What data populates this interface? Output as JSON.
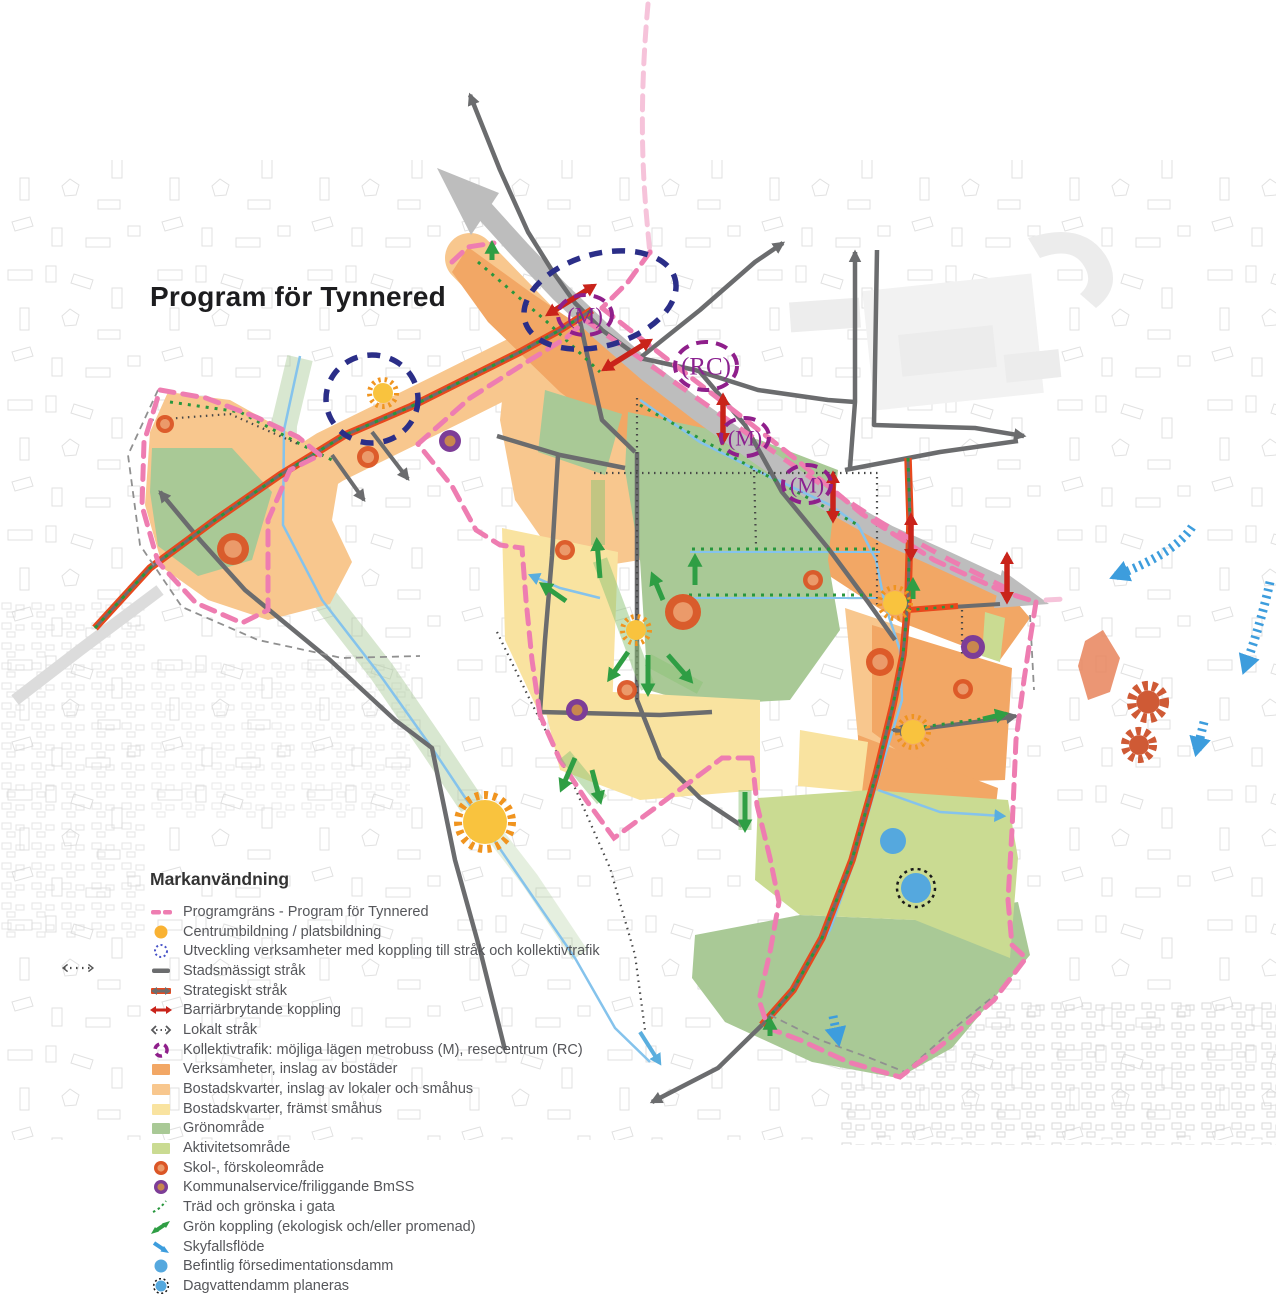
{
  "title": "Program för Tynnered",
  "legend": {
    "heading": "Markanvändning",
    "items": [
      {
        "icon": "program-boundary-icon",
        "label": "Programgräns - Program för Tynnered",
        "color": "#ee7db1"
      },
      {
        "icon": "centre-formation-icon",
        "label": "Centrumbildning / platsbildning",
        "color": "#f9b233"
      },
      {
        "icon": "development-dotted-circle-icon",
        "label": "Utveckling verksamheter med koppling till stråk och kollektivtrafik",
        "color": "#4a55c8"
      },
      {
        "icon": "urban-route-icon",
        "label": "Stadsmässigt stråk",
        "color": "#6b6c6e"
      },
      {
        "icon": "strategic-route-icon",
        "label": "Strategiskt stråk",
        "color": "#e8481d"
      },
      {
        "icon": "barrier-breaking-icon",
        "label": "Barriärbrytande koppling",
        "color": "#c9231a"
      },
      {
        "icon": "local-route-icon",
        "label": "Lokalt stråk",
        "color": "#58595b"
      },
      {
        "icon": "public-transport-icon",
        "label": "Kollektivtrafik: möjliga lägen metrobuss (M), resecentrum (RC)",
        "color": "#8f1f8b"
      },
      {
        "icon": "business-area-icon",
        "label": "Verksamheter, inslag av bostäder",
        "color": "#f2a765"
      },
      {
        "icon": "mixed-housing-area-icon",
        "label": "Bostadskvarter, inslag av lokaler och småhus",
        "color": "#f8c78e"
      },
      {
        "icon": "small-house-area-icon",
        "label": "Bostadskvarter, främst småhus",
        "color": "#f9e3a0"
      },
      {
        "icon": "green-area-icon",
        "label": "Grönområde",
        "color": "#a9c996"
      },
      {
        "icon": "activity-area-icon",
        "label": "Aktivitetsområde",
        "color": "#cadb92"
      },
      {
        "icon": "school-area-icon",
        "label": "Skol-, förskoleområde",
        "color": "#db5626"
      },
      {
        "icon": "municipal-service-icon",
        "label": "Kommunalservice/friliggande BmSS",
        "color": "#7d3d97"
      },
      {
        "icon": "street-greenery-icon",
        "label": "Träd och grönska i gata",
        "color": "#28963d"
      },
      {
        "icon": "green-link-icon",
        "label": "Grön koppling (ekologisk och/eller promenad)",
        "color": "#2f9e44"
      },
      {
        "icon": "cloudburst-flow-icon",
        "label": "Skyfallsflöde",
        "color": "#3d9ddd"
      },
      {
        "icon": "sedimentation-pond-icon",
        "label": "Befintlig försedimentationsdamm",
        "color": "#55a8de"
      },
      {
        "icon": "stormwater-pond-icon",
        "label": "Dagvattendamm planeras",
        "color": "#55a8de"
      }
    ]
  },
  "map": {
    "colors": {
      "pink": "#ee7db1",
      "pink_light": "#f6c3da",
      "band": "#bdbdbd",
      "road": "#6b6c6e",
      "strategic_red": "#e8481d",
      "tree_green": "#28963d",
      "navy": "#2b2e88",
      "transit_purple": "#8f1f8b",
      "barrier_red": "#c9231a",
      "sun": "#f9c33e",
      "sun_ray": "#f0941f",
      "school_ring": "#db5626",
      "school_core": "#eb9a6a",
      "service_ring": "#7d3d97",
      "service_core": "#c8874e",
      "pond": "#55a8de",
      "sky": "#3d9ddd",
      "gear": "#cf5a35",
      "stream": "#85c3ec"
    },
    "transit_markers": [
      {
        "x": 585,
        "y": 315,
        "rx": 27,
        "ry": 20,
        "fs": 23,
        "label": "(M)"
      },
      {
        "x": 706,
        "y": 366,
        "rx": 31,
        "ry": 24,
        "fs": 25,
        "label": "(RC)"
      },
      {
        "x": 745,
        "y": 437,
        "rx": 24,
        "ry": 19,
        "fs": 22,
        "label": "(M)"
      },
      {
        "x": 807,
        "y": 484,
        "rx": 24,
        "ry": 19,
        "fs": 22,
        "label": "(M)"
      }
    ],
    "development_zones": [
      {
        "x": 372,
        "y": 399,
        "rx": 46,
        "ry": 44,
        "rot": 0
      },
      {
        "x": 600,
        "y": 300,
        "rx": 78,
        "ry": 46,
        "rot": -16
      }
    ],
    "suns": [
      {
        "x": 383,
        "y": 393,
        "r": 10
      },
      {
        "x": 636,
        "y": 630,
        "r": 10
      },
      {
        "x": 895,
        "y": 603,
        "r": 12
      },
      {
        "x": 913,
        "y": 732,
        "r": 12
      },
      {
        "x": 485,
        "y": 822,
        "r": 22
      }
    ],
    "schools": [
      {
        "x": 165,
        "y": 424,
        "r": 9
      },
      {
        "x": 233,
        "y": 549,
        "r": 16
      },
      {
        "x": 368,
        "y": 457,
        "r": 11
      },
      {
        "x": 565,
        "y": 550,
        "r": 10
      },
      {
        "x": 683,
        "y": 612,
        "r": 18
      },
      {
        "x": 627,
        "y": 690,
        "r": 10
      },
      {
        "x": 813,
        "y": 580,
        "r": 10
      },
      {
        "x": 880,
        "y": 662,
        "r": 14
      },
      {
        "x": 963,
        "y": 689,
        "r": 10
      }
    ],
    "services": [
      {
        "x": 450,
        "y": 441,
        "r": 11
      },
      {
        "x": 577,
        "y": 710,
        "r": 11
      },
      {
        "x": 973,
        "y": 647,
        "r": 12
      }
    ],
    "ponds": [
      {
        "x": 893,
        "y": 841,
        "r": 13,
        "planned": false
      },
      {
        "x": 916,
        "y": 888,
        "r": 15,
        "planned": true
      }
    ],
    "gears": [
      {
        "x": 1148,
        "y": 702,
        "r": 21
      },
      {
        "x": 1139,
        "y": 745,
        "r": 18
      }
    ],
    "barrier_links": [
      {
        "x": 571,
        "y": 300,
        "a": -32,
        "len": 52
      },
      {
        "x": 627,
        "y": 355,
        "a": -32,
        "len": 52
      },
      {
        "x": 723,
        "y": 419,
        "a": 90,
        "len": 44
      },
      {
        "x": 833,
        "y": 497,
        "a": 90,
        "len": 44
      },
      {
        "x": 911,
        "y": 537,
        "a": 90,
        "len": 40
      },
      {
        "x": 1007,
        "y": 578,
        "a": 90,
        "len": 44
      }
    ],
    "green_links": [
      {
        "x1": 600,
        "y1": 578,
        "x2": 597,
        "y2": 542
      },
      {
        "x1": 566,
        "y1": 601,
        "x2": 543,
        "y2": 585
      },
      {
        "x1": 695,
        "y1": 585,
        "x2": 695,
        "y2": 558
      },
      {
        "x1": 663,
        "y1": 600,
        "x2": 653,
        "y2": 576
      },
      {
        "x1": 628,
        "y1": 652,
        "x2": 610,
        "y2": 678
      },
      {
        "x1": 648,
        "y1": 655,
        "x2": 648,
        "y2": 692
      },
      {
        "x1": 668,
        "y1": 655,
        "x2": 690,
        "y2": 680
      },
      {
        "x1": 745,
        "y1": 792,
        "x2": 745,
        "y2": 828
      },
      {
        "x1": 575,
        "y1": 758,
        "x2": 562,
        "y2": 788
      },
      {
        "x1": 592,
        "y1": 770,
        "x2": 600,
        "y2": 800
      },
      {
        "x1": 913,
        "y1": 599,
        "x2": 913,
        "y2": 582
      },
      {
        "x1": 983,
        "y1": 719,
        "x2": 1004,
        "y2": 714
      },
      {
        "x1": 770,
        "y1": 1036,
        "x2": 770,
        "y2": 1021
      },
      {
        "x1": 492,
        "y1": 260,
        "x2": 492,
        "y2": 245
      }
    ],
    "skyfall": [
      {
        "d": "M1192,527 C1178,548 1150,562 1116,576"
      },
      {
        "d": "M1270,582 C1262,618 1252,648 1245,668"
      },
      {
        "d": "M1204,722 L1197,750"
      },
      {
        "d": "M833,1016 L838,1040"
      }
    ]
  }
}
